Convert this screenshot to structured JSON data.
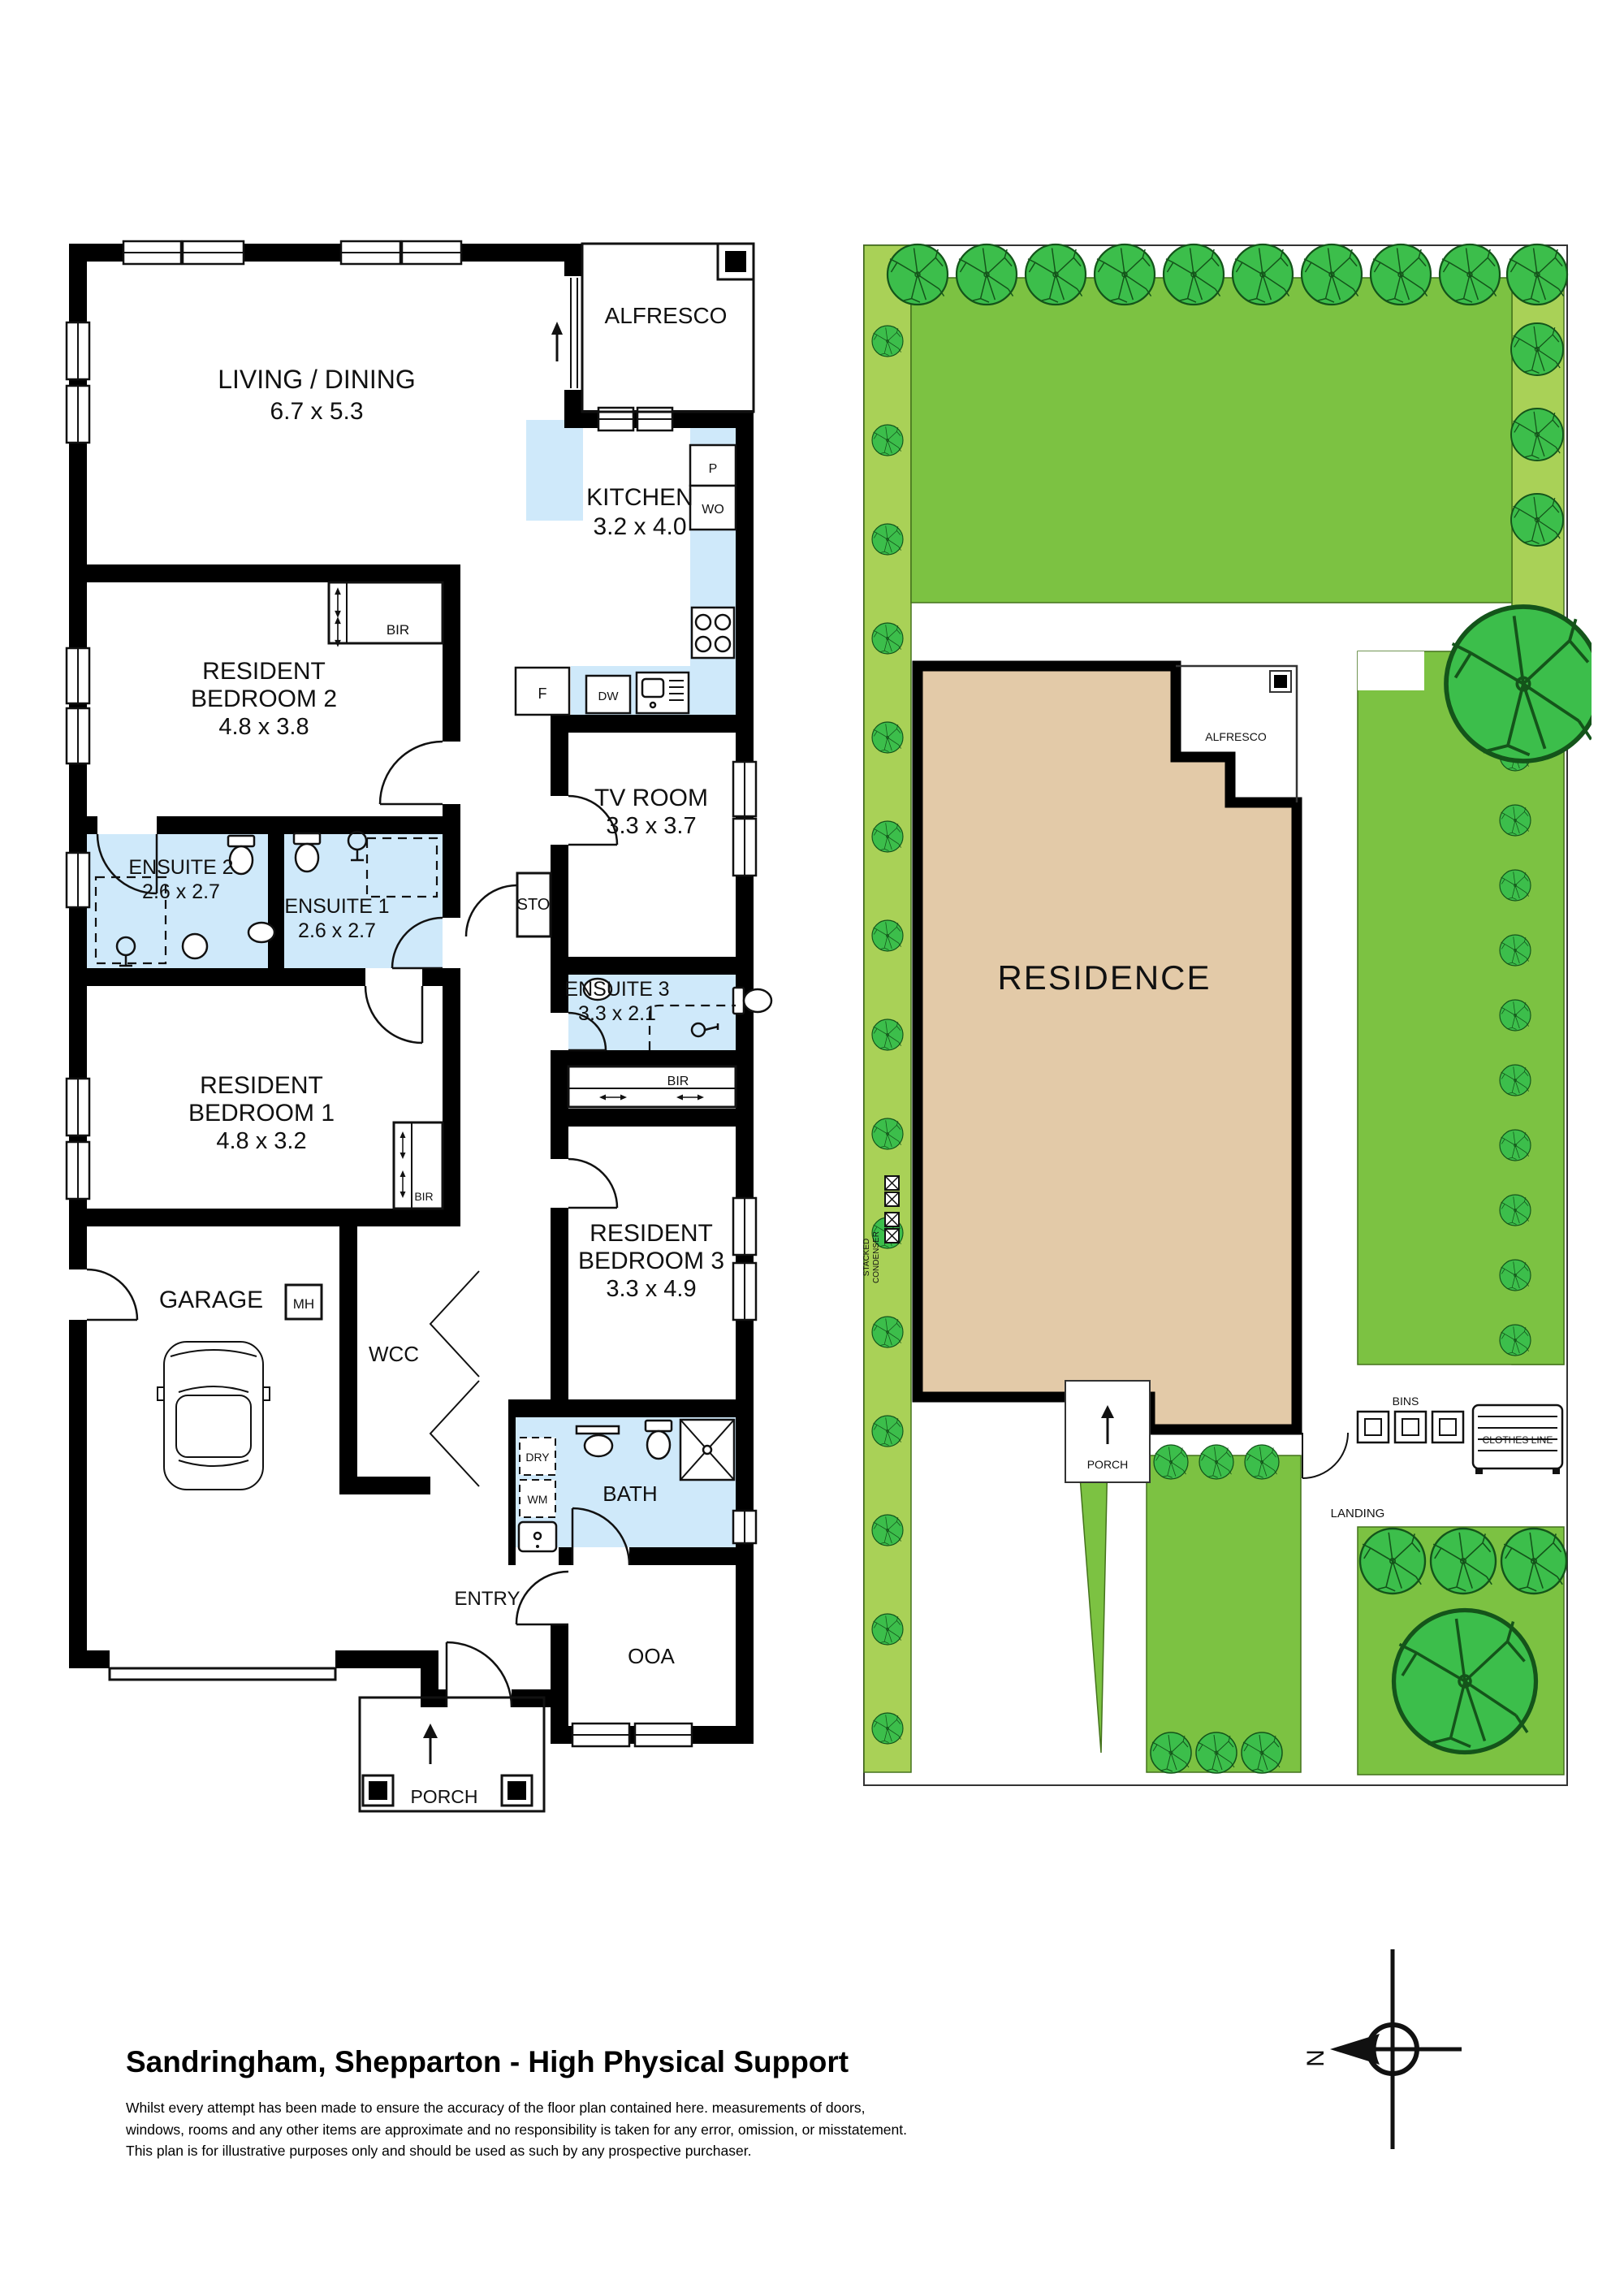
{
  "floor_plan": {
    "living": {
      "name": "LIVING / DINING",
      "dims": "6.7 x 5.3"
    },
    "alfresco": {
      "name": "ALFRESCO"
    },
    "kitchen": {
      "name": "KITCHEN",
      "dims": "3.2 x 4.0"
    },
    "bedroom2": {
      "line1": "RESIDENT",
      "line2": "BEDROOM 2",
      "dims": "4.8 x 3.8"
    },
    "ensuite2": {
      "name": "ENSUITE 2",
      "dims": "2.6 x 2.7"
    },
    "ensuite1": {
      "name": "ENSUITE 1",
      "dims": "2.6 x 2.7"
    },
    "tv_room": {
      "name": "TV ROOM",
      "dims": "3.3 x 3.7"
    },
    "storage": {
      "name": "STO"
    },
    "ensuite3": {
      "name": "ENSUITE 3",
      "dims": "3.3 x 2.1"
    },
    "bedroom1": {
      "line1": "RESIDENT",
      "line2": "BEDROOM 1",
      "dims": "4.8 x 3.2"
    },
    "bedroom3": {
      "line1": "RESIDENT",
      "line2": "BEDROOM 3",
      "dims": "3.3 x 4.9"
    },
    "garage": {
      "name": "GARAGE"
    },
    "wcc": {
      "name": "WCC"
    },
    "bath": {
      "name": "BATH"
    },
    "entry": {
      "name": "ENTRY"
    },
    "ooa": {
      "name": "OOA"
    },
    "porch": {
      "name": "PORCH"
    },
    "labels": {
      "bir": "BIR",
      "pantry": "P",
      "wall_oven": "WO",
      "fridge": "F",
      "dishwasher": "DW",
      "manhole": "MH",
      "dryer": "DRY",
      "washing_machine": "WM"
    }
  },
  "site_plan": {
    "residence": "RESIDENCE",
    "alfresco": "ALFRESCO",
    "porch": "PORCH",
    "landing": "LANDING",
    "bins": "BINS",
    "clothes_line": "CLOTHES LINE",
    "stacked_condenser_line1": "STACKED",
    "stacked_condenser_line2": "CONDENSER"
  },
  "compass": {
    "north": "N"
  },
  "footer": {
    "title": "Sandringham, Shepparton - High Physical Support",
    "disclaimer_line1": "Whilst every attempt has been made to ensure the accuracy of the floor plan contained here. measurements of doors,",
    "disclaimer_line2": "windows, rooms and any other items are approximate and no responsibility is taken for any error, omission, or misstatement.",
    "disclaimer_line3": "This plan is for illustrative purposes only and should be used as such by any prospective purchaser."
  },
  "colors": {
    "lawn": "#7cc242",
    "strip": "#a9d157",
    "tree": "#3cbe4b",
    "tree_outline": "#14541a",
    "residence_fill": "#e3caa8",
    "wet_area": "#cfe9fa",
    "wall": "#000000"
  }
}
